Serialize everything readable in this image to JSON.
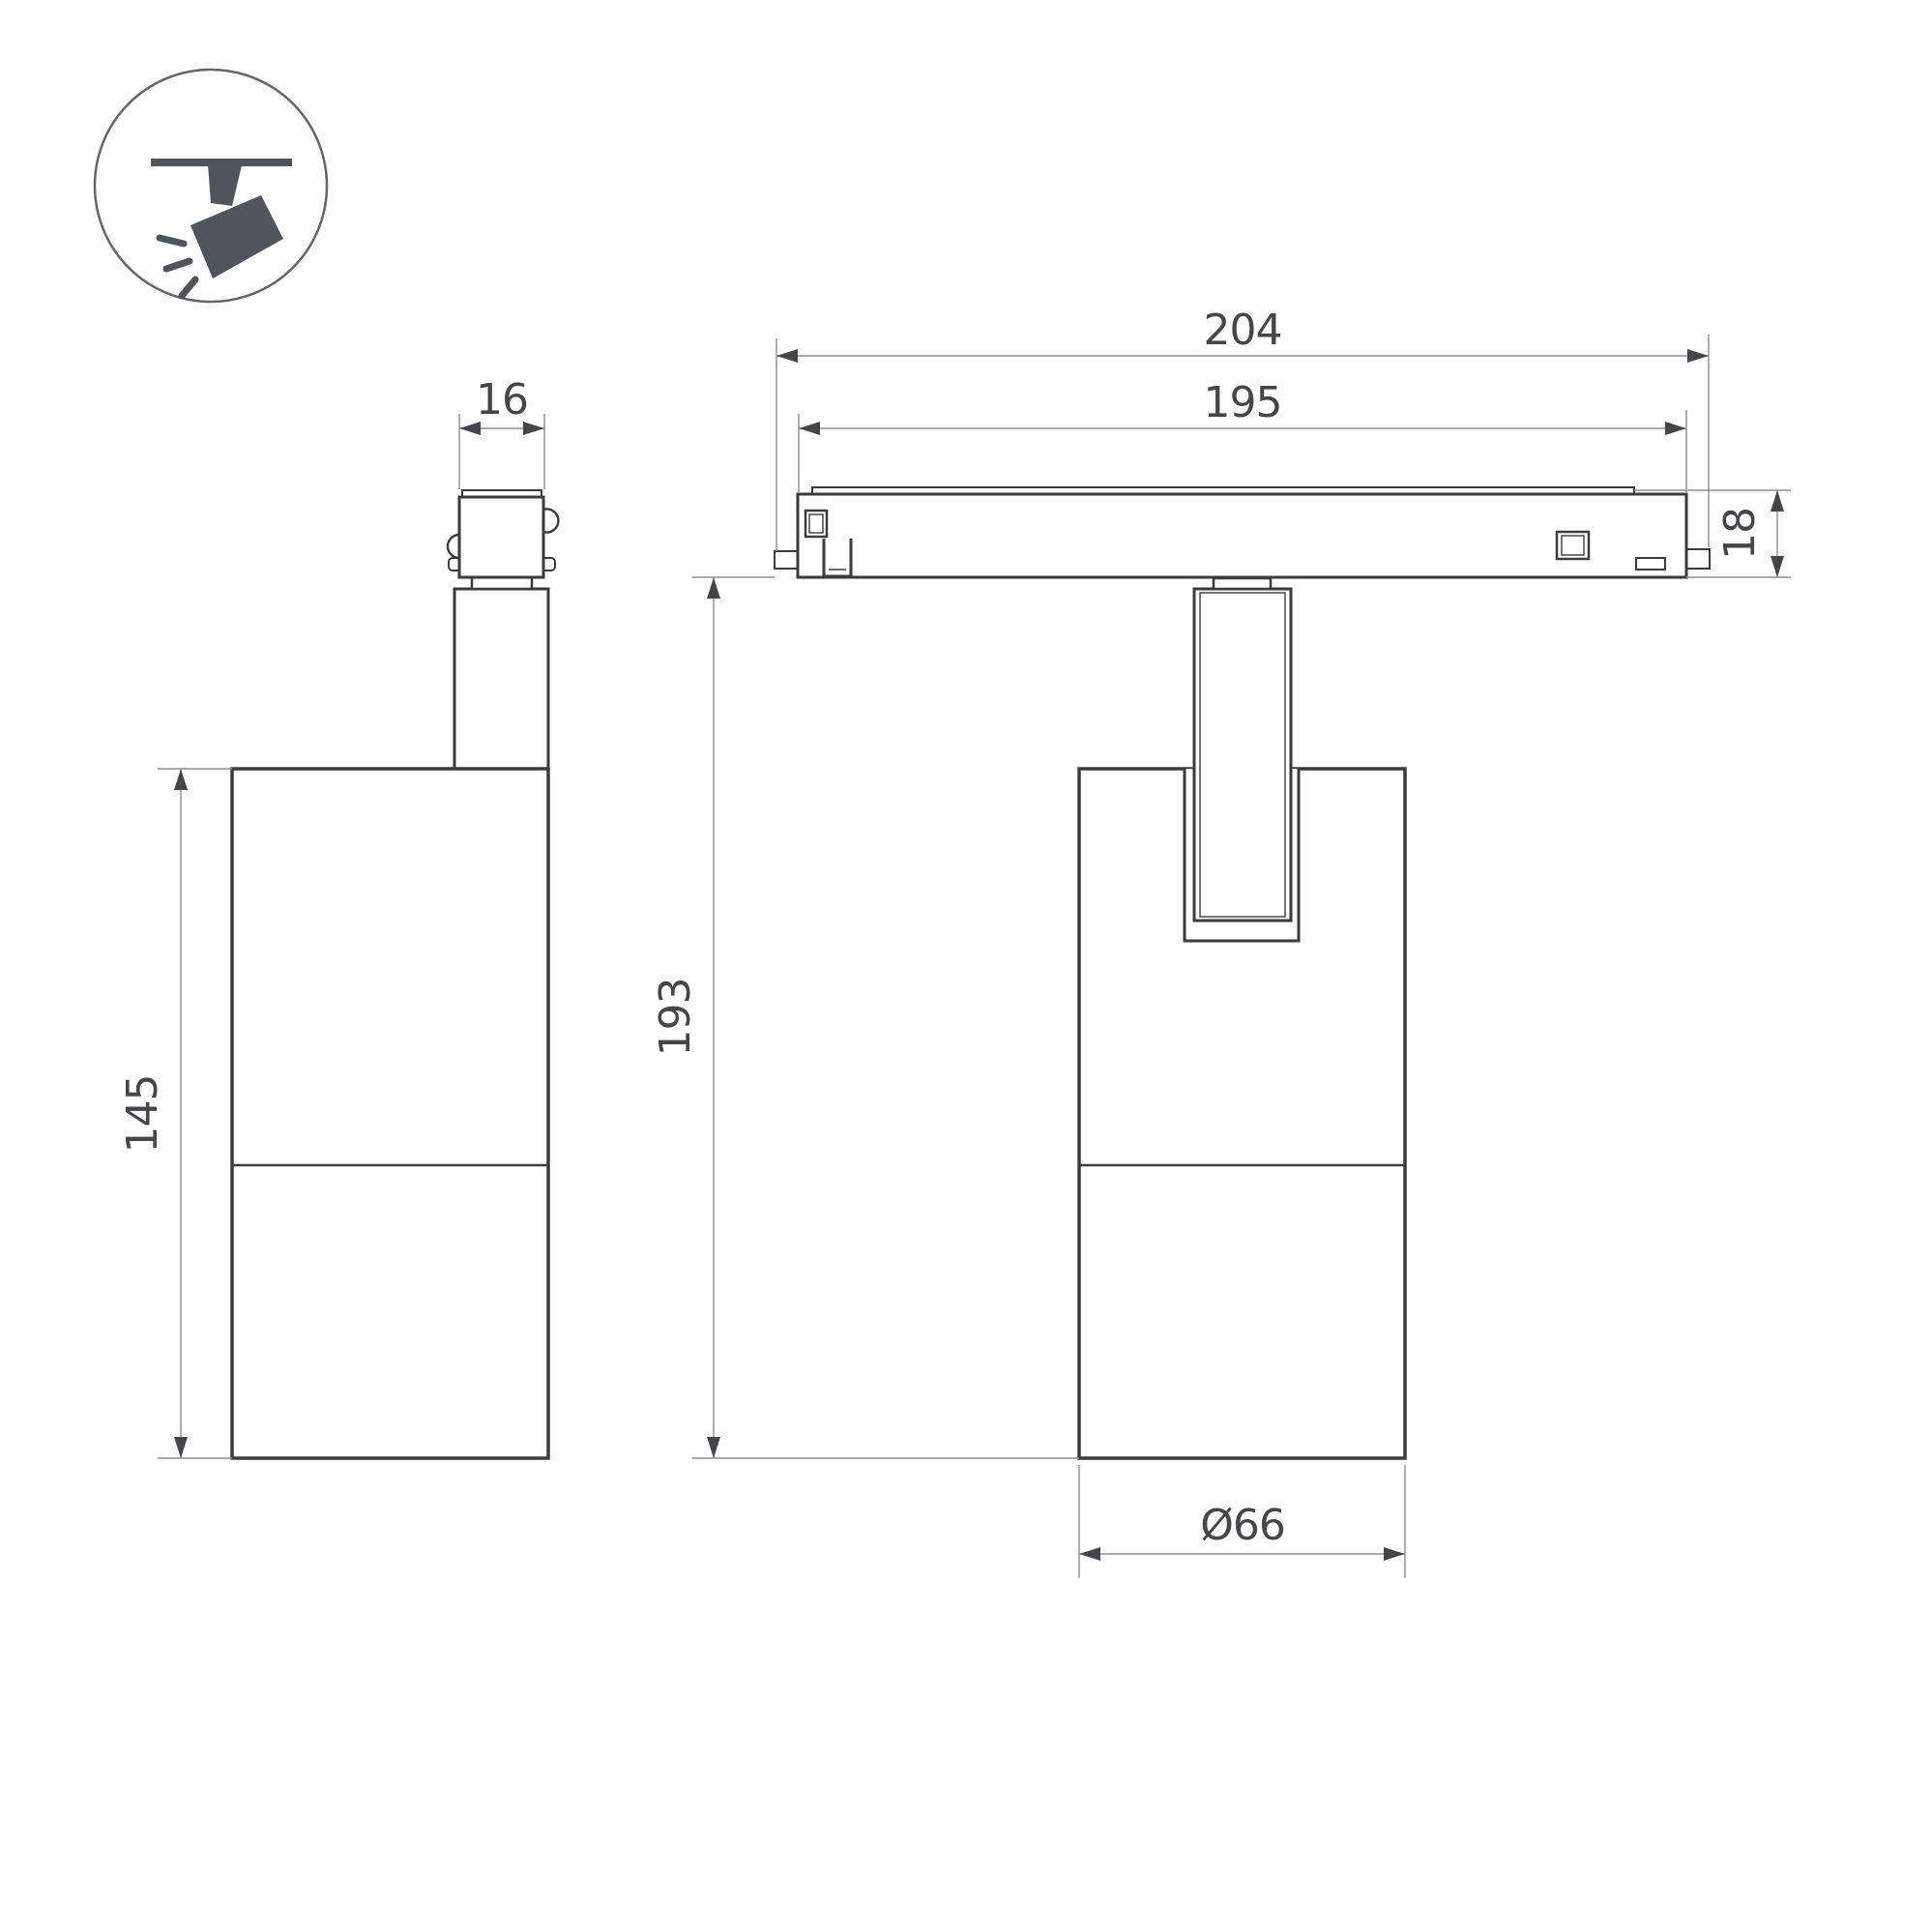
{
  "page": {
    "background": "#ffffff"
  },
  "colors": {
    "outline": "#3b3b3f",
    "dimension_line": "#8f8f8f",
    "dimension_text": "#46464a",
    "icon_fill": "#4e555c"
  },
  "icon": {
    "name": "track-spotlight-icon"
  },
  "views": {
    "side_view": {
      "name": "side view of track spotlight",
      "dims": {
        "adapter_width": "16",
        "body_height": "145"
      }
    },
    "front_view": {
      "name": "front view of track spotlight on magnetic track",
      "dims": {
        "track_overall_length": "204",
        "track_body_length": "195",
        "track_height": "18",
        "fixture_drop_height": "193",
        "body_diameter": "Ø66"
      }
    }
  },
  "dims": {
    "adapter_width": "16",
    "body_height": "145",
    "track_overall": "204",
    "track_body": "195",
    "track_height": "18",
    "drop_height": "193",
    "body_diameter": "Ø66"
  }
}
